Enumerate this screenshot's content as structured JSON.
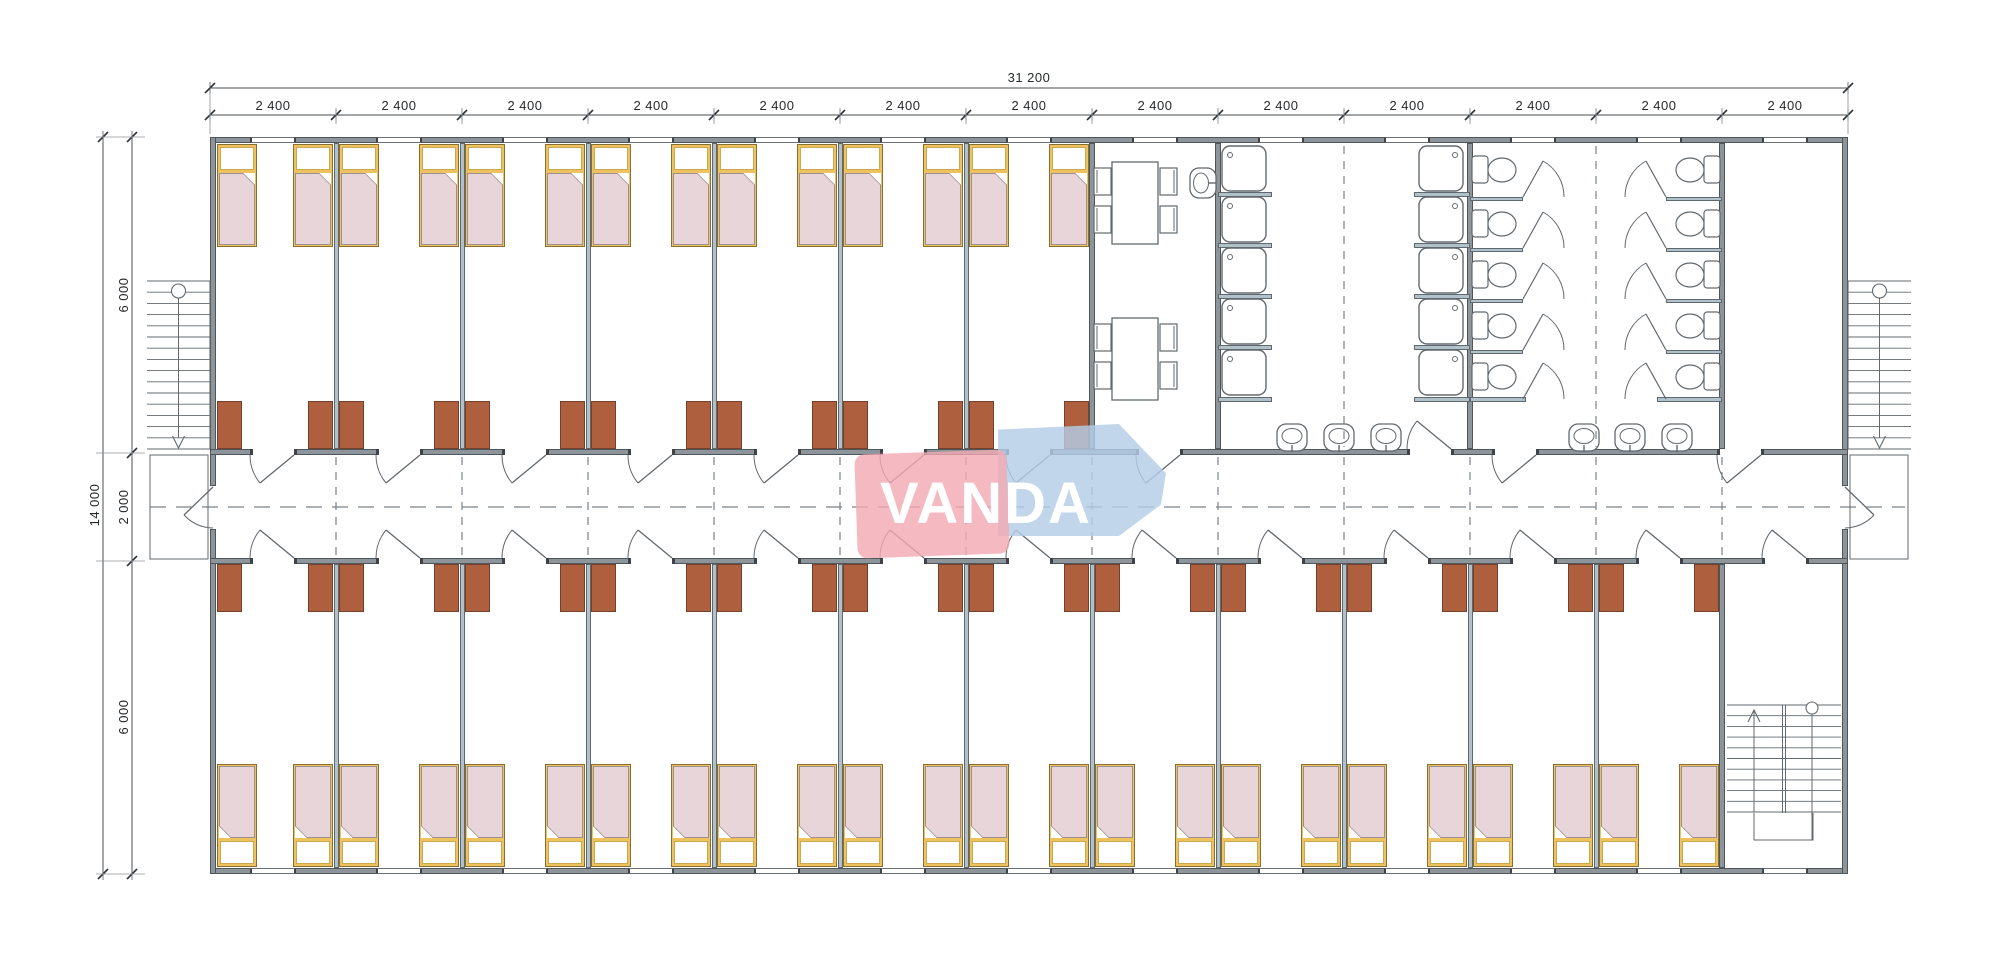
{
  "watermark": {
    "text": "VANDA"
  },
  "dimensions": {
    "total_width_mm": "31 200",
    "bay_width_mm": "2 400",
    "bay_count": 13,
    "total_depth_mm": "14 000",
    "top_room_depth_mm": "6 000",
    "corridor_depth_mm": "2 000",
    "bottom_room_depth_mm": "6 000"
  },
  "fixtures": {
    "beds": 38,
    "desks": 38,
    "dining_tables": 2,
    "dining_chairs": 8,
    "shower_trays": 10,
    "toilets": 10,
    "washbasins": 7,
    "exterior_staircases": 2,
    "interior_staircases": 1
  },
  "colors": {
    "wall": "#8d959b",
    "wall_edge": "#4e555b",
    "partition": "#b0c1c9",
    "partition_edge": "#5f686e",
    "fixture_line": "#62696f",
    "desk": "#ae5f3e",
    "desk_edge": "#74402a",
    "bed_frame": "#eec25f",
    "bed_frame_edge": "#8a6f33",
    "mattress": "#e7d5d9",
    "mattress_edge": "#9b8f92",
    "dimension_text": "#26292c",
    "dimension_line": "#4a4f54",
    "dash_line": "#7a828a",
    "watermark_pink": "#f2a9b2",
    "watermark_blue": "#b5cde6",
    "watermark_text": "#ffffff"
  }
}
